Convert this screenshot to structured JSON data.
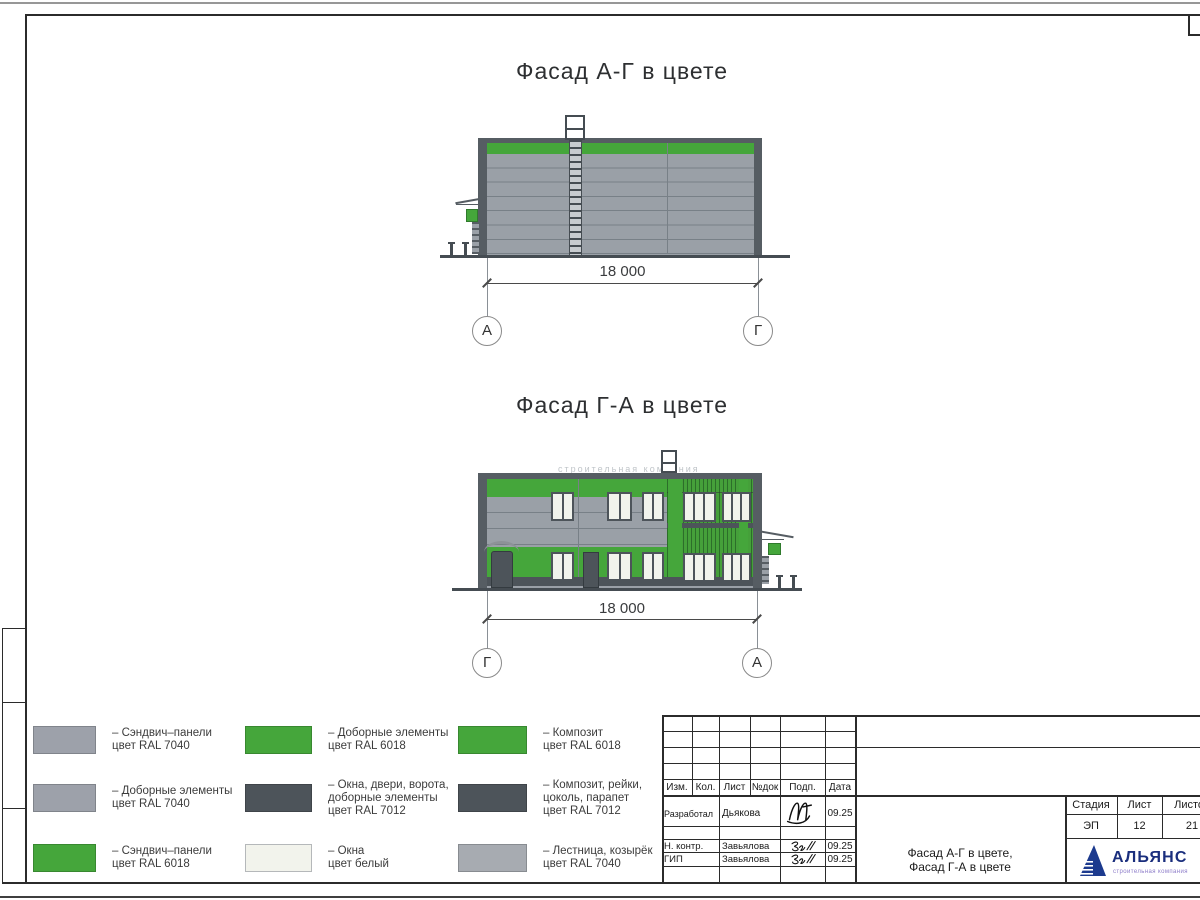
{
  "sheet": {
    "facade_top": {
      "title": "Фасад А-Г в цвете",
      "dimension": "18 000",
      "axis_left": "А",
      "axis_right": "Г"
    },
    "facade_bottom": {
      "title": "Фасад Г-А в цвете",
      "dimension": "18 000",
      "axis_left": "Г",
      "axis_right": "А",
      "watermark": "строительная компания"
    },
    "legend": {
      "items": [
        {
          "color": "#9da1aa",
          "text": "– Сэндвич–панели\nцвет RAL 7040"
        },
        {
          "color": "#9da1aa",
          "text": "– Доборные элементы\nцвет RAL 7040"
        },
        {
          "color": "#45a63b",
          "text": "– Сэндвич–панели\nцвет RAL 6018"
        },
        {
          "color": "#45a63b",
          "text": "– Доборные элементы\nцвет RAL 6018"
        },
        {
          "color": "#4d545a",
          "text": "– Окна, двери, ворота,\nдоборные элементы\nцвет RAL 7012"
        },
        {
          "color": "#f2f3ec",
          "text": "– Окна\nцвет белый"
        },
        {
          "color": "#45a63b",
          "text": "– Композит\nцвет RAL 6018"
        },
        {
          "color": "#4d545a",
          "text": "– Композит, рейки,\nцоколь, парапет\nцвет RAL 7012"
        },
        {
          "color": "#a7abb1",
          "text": "– Лестница, козырёк\nцвет RAL 7040"
        }
      ]
    },
    "titleblock": {
      "columns": [
        "Изм.",
        "Кол.",
        "Лист",
        "№док",
        "Подп.",
        "Дата"
      ],
      "rows": [
        {
          "role": "Разработал",
          "name": "Дьякова",
          "date": "09.25"
        },
        {
          "role": "Н. контр.",
          "name": "Завьялова",
          "date": "09.25"
        },
        {
          "role": "ГИП",
          "name": "Завьялова",
          "date": "09.25"
        }
      ],
      "stage": {
        "headers": [
          "Стадия",
          "Лист",
          "Листов"
        ],
        "values": [
          "ЭП",
          "12",
          "21"
        ]
      },
      "doc_title": "Фасад А-Г в цвете,\nФасад Г-А в цвете",
      "logo": {
        "name": "АЛЬЯНС",
        "subtitle": "строительная компания"
      }
    },
    "colors": {
      "ral_7040": "#9da1aa",
      "ral_6018": "#45a63b",
      "ral_7012": "#4d545a",
      "window_white": "#f2f3ec",
      "stair_gray": "#a7abb1",
      "frame_black": "#2b2b2b",
      "logo_blue": "#1a2e7d",
      "logo_subtitle": "#8d7cc9"
    }
  }
}
